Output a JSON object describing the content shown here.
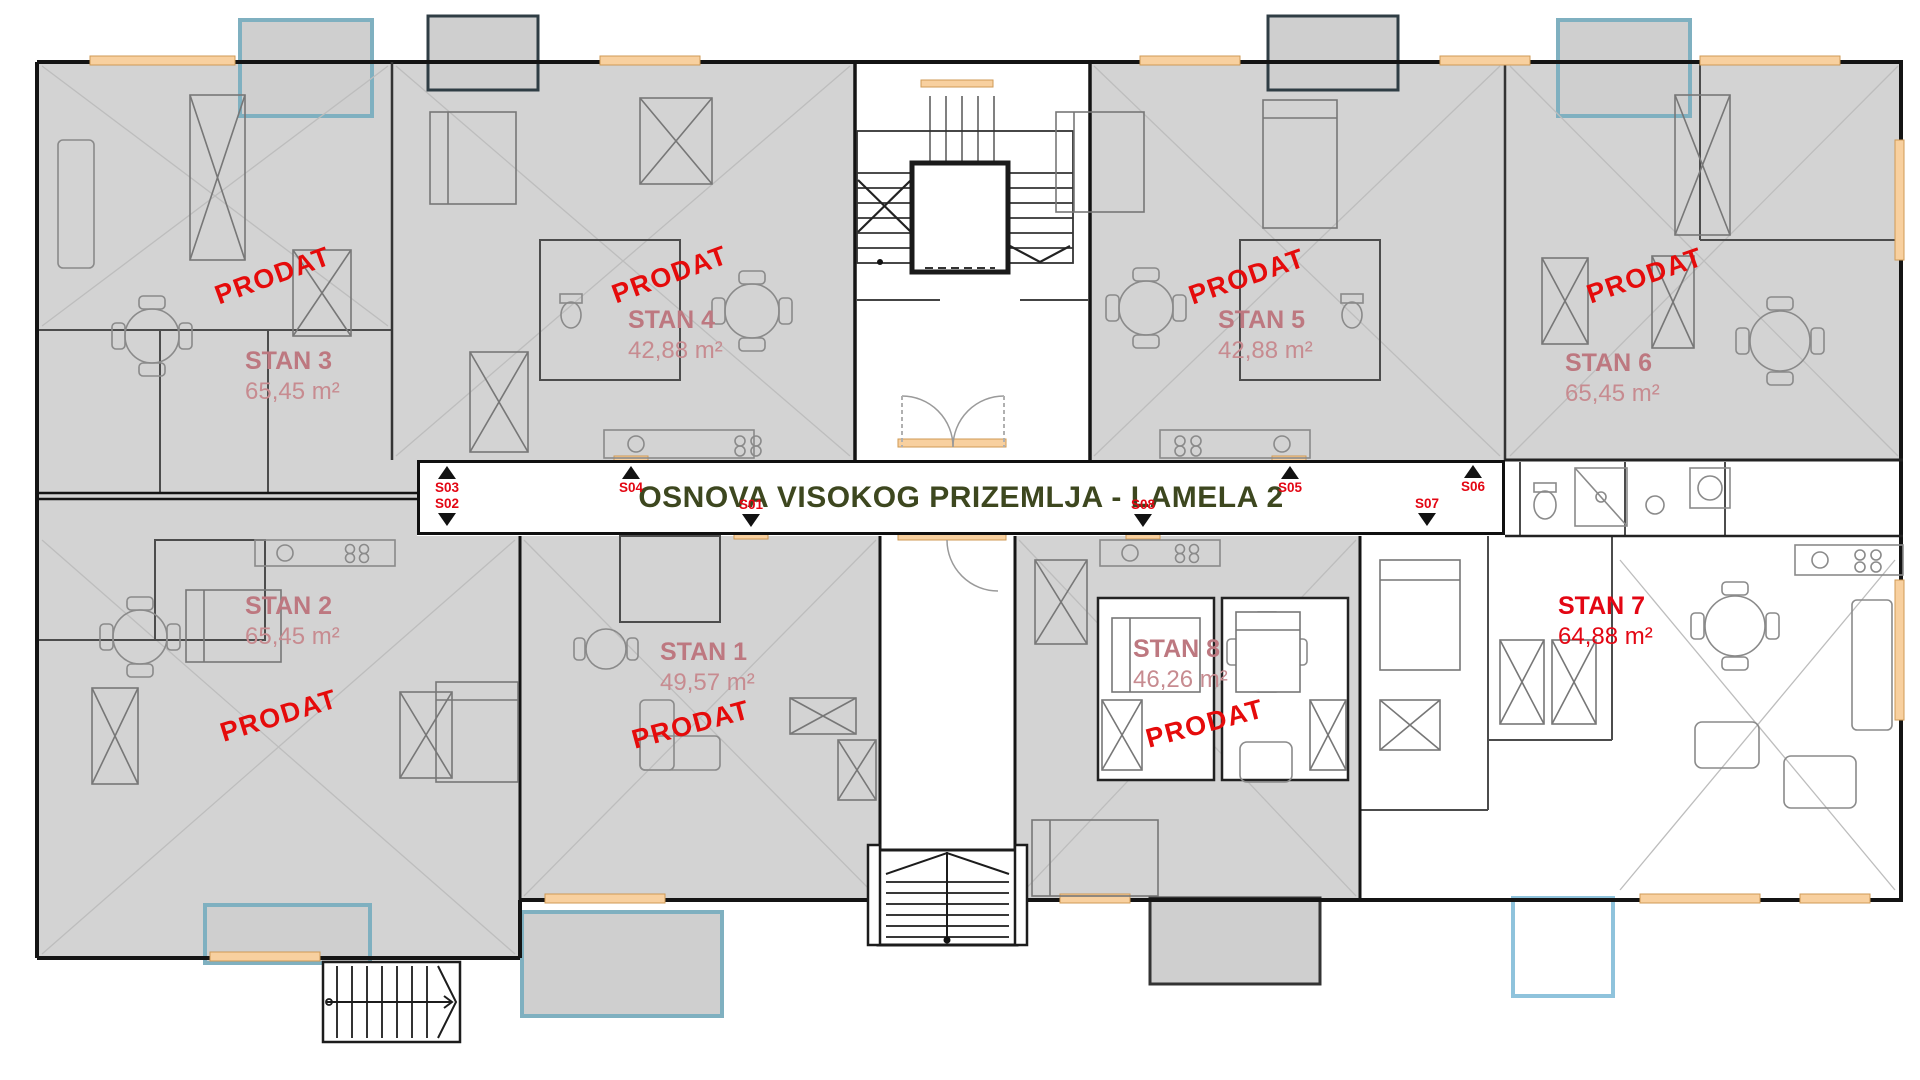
{
  "title": "OSNOVA VISOKOG PRIZEMLJA - LAMELA 2",
  "apartments": [
    {
      "id": "stan-1",
      "name": "STAN 1",
      "area": "49,57 m²",
      "sold": true,
      "status_label": "PRODAT"
    },
    {
      "id": "stan-2",
      "name": "STAN 2",
      "area": "65,45 m²",
      "sold": true,
      "status_label": "PRODAT"
    },
    {
      "id": "stan-3",
      "name": "STAN 3",
      "area": "65,45 m²",
      "sold": true,
      "status_label": "PRODAT"
    },
    {
      "id": "stan-4",
      "name": "STAN 4",
      "area": "42,88 m²",
      "sold": true,
      "status_label": "PRODAT"
    },
    {
      "id": "stan-5",
      "name": "STAN 5",
      "area": "42,88 m²",
      "sold": true,
      "status_label": "PRODAT"
    },
    {
      "id": "stan-6",
      "name": "STAN 6",
      "area": "65,45 m²",
      "sold": true,
      "status_label": "PRODAT"
    },
    {
      "id": "stan-7",
      "name": "STAN 7",
      "area": "64,88 m²",
      "sold": false,
      "status_label": ""
    },
    {
      "id": "stan-8",
      "name": "STAN 8",
      "area": "46,26 m²",
      "sold": true,
      "status_label": "PRODAT"
    }
  ],
  "markers": [
    {
      "label": "S01",
      "direction": "down"
    },
    {
      "label": "S02",
      "direction": "down"
    },
    {
      "label": "S03",
      "direction": "up"
    },
    {
      "label": "S04",
      "direction": "up"
    },
    {
      "label": "S05",
      "direction": "up"
    },
    {
      "label": "S06",
      "direction": "up"
    },
    {
      "label": "S07",
      "direction": "down"
    },
    {
      "label": "S08",
      "direction": "down"
    }
  ],
  "colors": {
    "sold_overlay": "#d3d3d3",
    "sold_label": "#bd7880",
    "available_label": "#e30613",
    "prodat_stamp": "#e50b0b",
    "title_text": "#3d471f",
    "marker_text": "#e30613",
    "wall": "#141414",
    "window_accent": "#f8d09f",
    "terrace_border": "#7fb0c0"
  }
}
